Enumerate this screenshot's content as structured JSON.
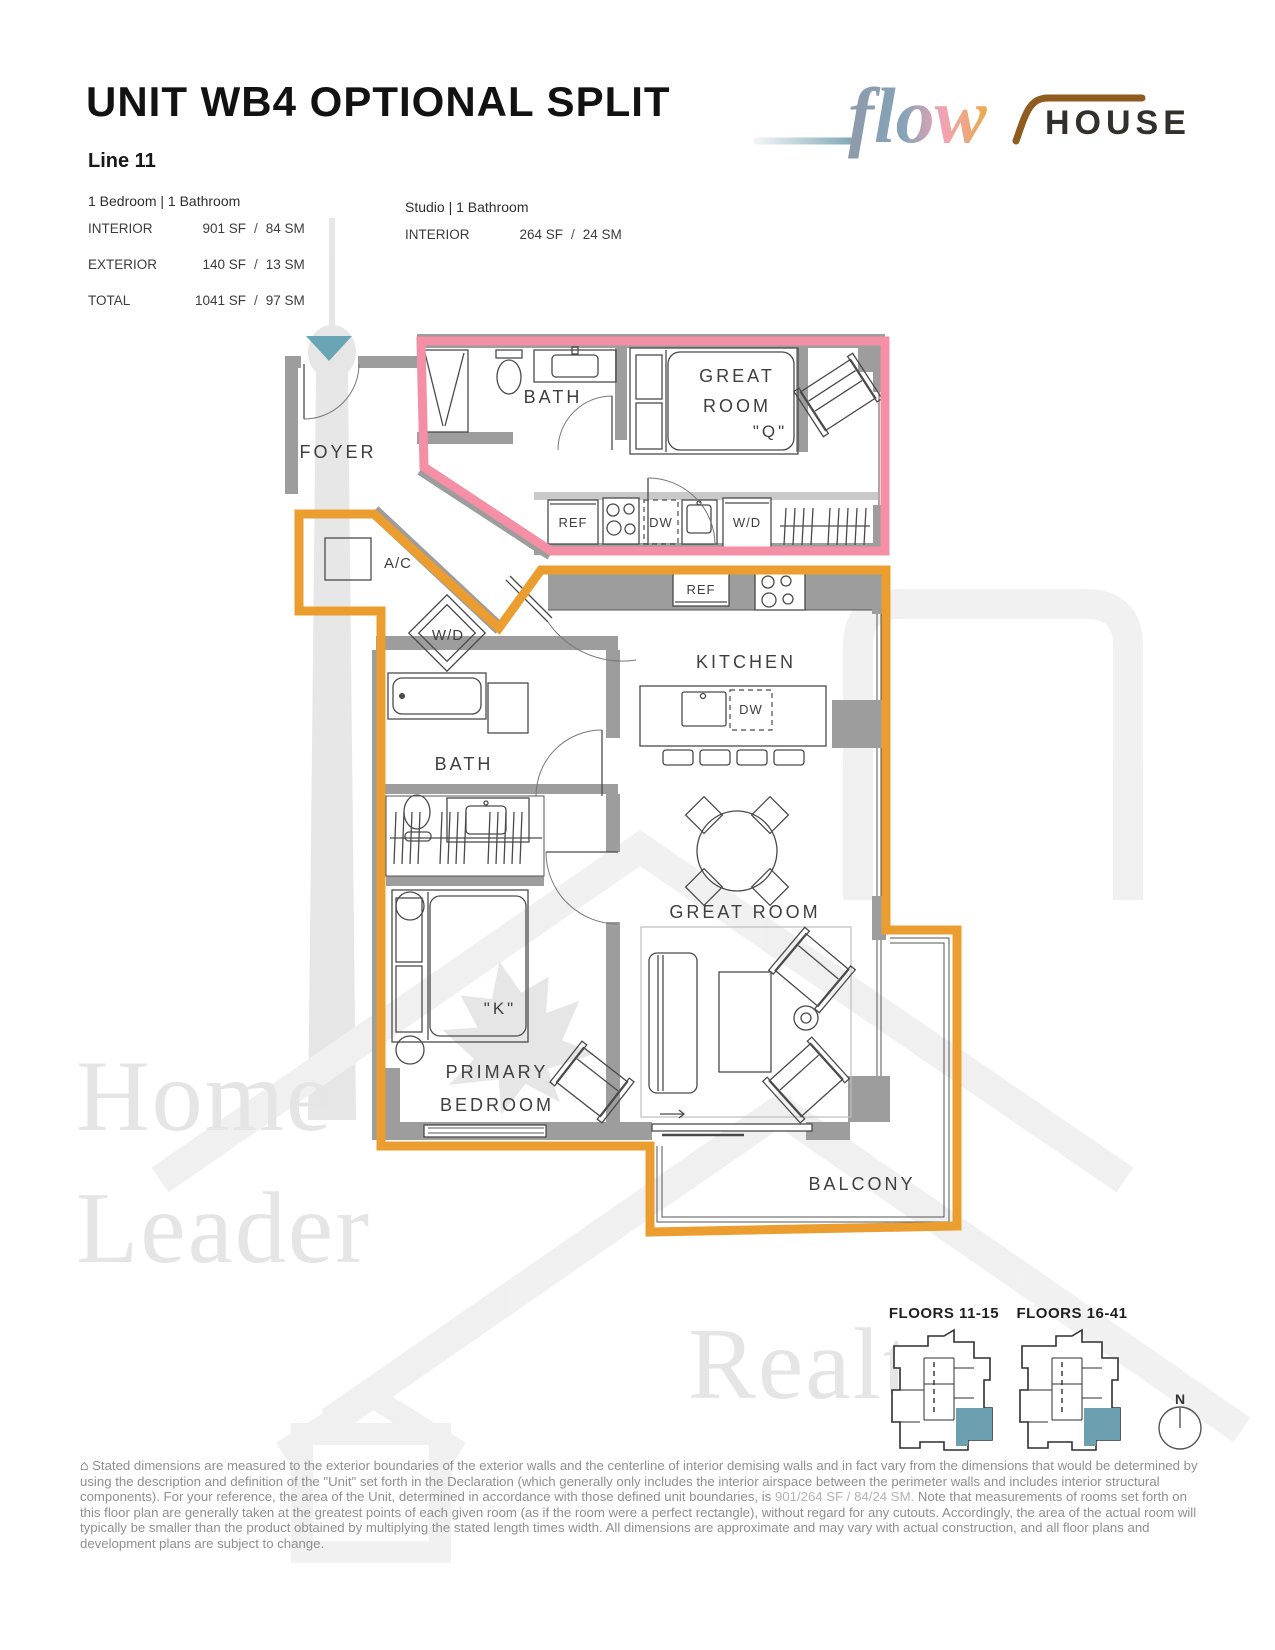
{
  "header": {
    "title": "UNIT WB4 OPTIONAL SPLIT",
    "line_label": "Line 11",
    "sep": "/",
    "main_unit": {
      "config": "1 Bedroom | 1 Bathroom",
      "rows": [
        {
          "label": "INTERIOR",
          "sf": "901 SF",
          "sm": "84 SM"
        },
        {
          "label": "EXTERIOR",
          "sf": "140 SF",
          "sm": "13 SM"
        },
        {
          "label": "TOTAL",
          "sf": "1041 SF",
          "sm": "97 SM"
        }
      ]
    },
    "studio_unit": {
      "config": "Studio | 1 Bathroom",
      "rows": [
        {
          "label": "INTERIOR",
          "sf": "264 SF",
          "sm": "24 SM"
        }
      ]
    }
  },
  "logo": {
    "script": "flow",
    "word": "HOUSE"
  },
  "plan": {
    "rooms": {
      "foyer": "FOYER",
      "studio_bath": "BATH",
      "studio_great_1": "GREAT",
      "studio_great_2": "ROOM",
      "studio_bed_size": "\"Q\"",
      "ac": "A/C",
      "corridor_wd": "W/D",
      "main_bath": "BATH",
      "kitchen": "KITCHEN",
      "great_room": "GREAT ROOM",
      "primary_bed_size": "\"K\"",
      "primary_1": "PRIMARY",
      "primary_2": "BEDROOM",
      "balcony": "BALCONY"
    },
    "appliances": {
      "studio_ref": "REF",
      "studio_dw": "DW",
      "studio_wd": "W/D",
      "main_ref": "REF",
      "island_dw": "DW"
    }
  },
  "keyplans": {
    "left_title": "FLOORS 11-15",
    "right_title": "FLOORS 16-41",
    "north": "N"
  },
  "disclaimer": {
    "icon": "⌂",
    "part1": "Stated dimensions are measured to the exterior boundaries of the exterior walls and the centerline of interior demising walls and in fact vary from the dimensions that would be determined by using the description and definition of the \"Unit\" set forth in the Declaration (which generally only includes the interior airspace between the perimeter walls and includes interior structural components).  For your reference, the area of the Unit, determined in accordance with those defined unit boundaries, is ",
    "highlight": "901/264 SF / 84/24 SM.",
    "part2": " Note that measurements of rooms set forth on this floor plan are generally taken at the greatest points of each given room (as if the room were a perfect rectangle), without regard for any cutouts.  Accordingly, the area of the actual room will typically be smaller than the product obtained by multiplying the stated length times width.  All dimensions are approximate and may vary with actual construction, and all floor plans and development plans are subject to change."
  },
  "colors": {
    "studio_outline": "#F48FA5",
    "main_outline": "#EC9D2F",
    "entry_marker": "#69A5B5",
    "keyplan_unit": "#6CA0B0"
  }
}
